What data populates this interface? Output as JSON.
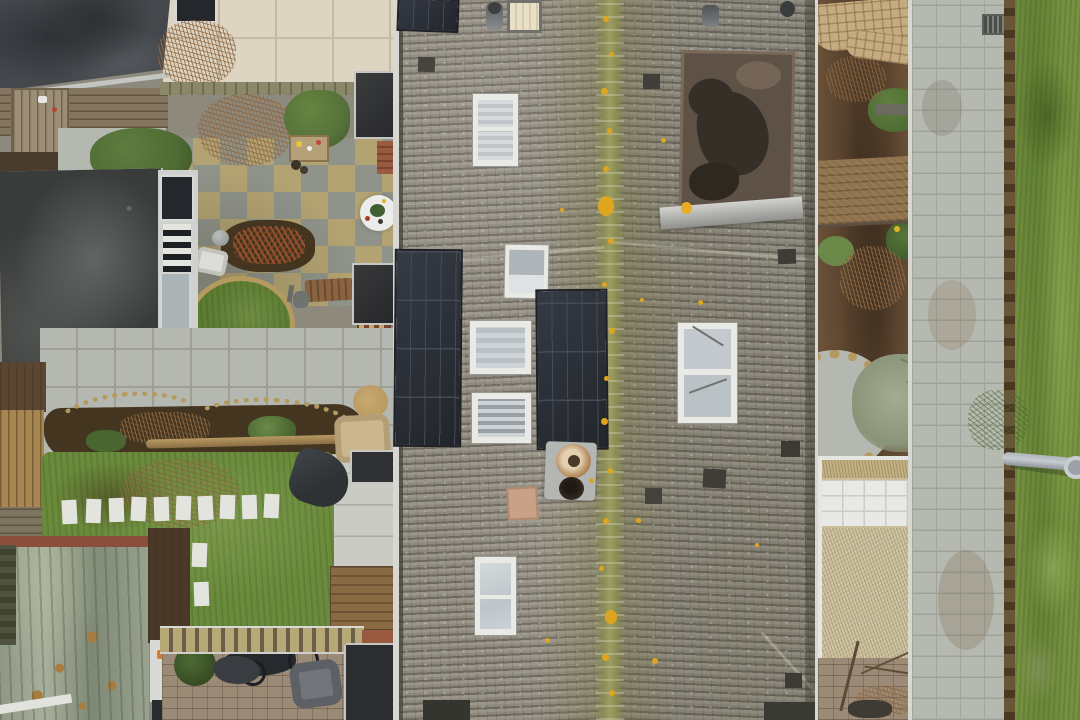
{
  "scene": {
    "description": "Top-down aerial drone photo of a row of terraced houses in winter: a large weathered grey tiled pitched roof runs vertically through the center with a moss-and-lichen covered ridge, white skylight windows, dark solar panels, a chimney and a dark repaired patch of roof tiles. Left side shows back gardens with checkered and grey paving, lawns with stepping stones, fences, sheds, a pergola with bicycles and flat bitumen roofs. Right side shows a front garden with curved cobblestone edging, shrubs and bare winter plants, a gravel-topped porch roof with white skylight tiles, a grey paver sidewalk and a grass verge with a street lamp.",
    "view": "orthographic top-down",
    "season": "winter"
  },
  "objects": [
    "center-pitched-roof",
    "mossy-ridge",
    "lichen-spots",
    "solar-panels",
    "skylight-windows",
    "roof-repair-patch",
    "chimney",
    "vent-caps",
    "left-back-gardens",
    "beige-patio",
    "checkered-paving",
    "circular-lawn",
    "garden-table",
    "flat-bitumen-roof",
    "slate-roof",
    "mossy-garage-roof",
    "stepping-stones",
    "wavy-brick-border",
    "pergola",
    "bicycles",
    "garden-chair",
    "front-garden",
    "cobblestone-path",
    "porch-roof",
    "gravel-flat-roof",
    "white-skylight-strip",
    "sidewalk",
    "grass-verge",
    "street-lamp",
    "fences",
    "sheds"
  ],
  "palette": {
    "roofBase": "#8E897D",
    "roofRowDark": "#6F6A60",
    "roofRowLight": "#9B968A",
    "roofBase2": "#878276",
    "roofRowDark2": "#67645B",
    "roofRowLight2": "#938E83",
    "mossRidge": "#8A8C55",
    "mossRidgeLight": "#9C9E62",
    "lichenYellow": "#DFA51F",
    "gutterWhite": "#D8D7D2",
    "eaveDark": "#3E3D38",
    "solarGrid": "#454B55",
    "solarFrame": "#1F2126",
    "veluxFrame": "#E9E9E5",
    "veluxGlass": "#C3C9CD",
    "veluxGlassDark": "#AEB5BA",
    "louvreDark": "#98A0A5",
    "repairBase": "#5E5146",
    "repairDark": "#362F27",
    "metalStrip": "#C0C1BD",
    "chimneyCap": "#E2D0B0",
    "chimneyCapDark": "#B98F62",
    "pipeDark": "#352C22",
    "patchTan": "#C9A186",
    "bitumen": "#3A3C3B",
    "bitumenWet": "#6A6E6A",
    "slate": "#44484C",
    "slateDark": "#2F3337",
    "mossyRoof": "#97A08C",
    "rustDot": "#A87B3F",
    "fasciaRed": "#8A4F3A",
    "patioBeige": "#DDD5C2",
    "patioLine": "#C4BBA6",
    "checkTan": "#B3A372",
    "checkGrey": "#8F938A",
    "pavingGrey": "#B5B7B1",
    "pavingLine": "#9EA098",
    "pavingWhite": "#CACBC5",
    "lawnGreen": "#6A8B3C",
    "lawnDark": "#4F5C2A",
    "lawnCircle": "#5C7D33",
    "soilDark": "#43351F",
    "soilBrown": "#6B5138",
    "shrubBrown": "#8A6A47",
    "hedgeGreen": "#4E6B33",
    "bushGreen": "#55713A",
    "brickEdge": "#B59A5F",
    "stoneWhite": "#E4E4DE",
    "woodTan": "#A8864F",
    "woodBrown": "#5A4632",
    "woodGrey": "#7D7461",
    "shedBrown": "#4A3828",
    "pergolaSlat": "#B7A878",
    "pergolaGap": "#6B5F48",
    "brickPatio": "#9B8A76",
    "bikeDark": "#26292D",
    "chairGrey": "#71757A",
    "tarpDark": "#2E3234",
    "benchWood": "#7A5636",
    "sofaBeige": "#CBB68E",
    "tableWood": "#B99A62",
    "whiteTable": "#ECECEA",
    "cobbleTan": "#C6AB80",
    "sidewalkGrey": "#B6B9B0",
    "sidewalkLine": "#9FA298",
    "curbWhite": "#D8D8D2",
    "grassGreen": "#74923F",
    "grassDark": "#5D7C34",
    "grassLight": "#8FAE5E",
    "soilEdge": "#6B5537",
    "lampPole": "#C6CBCF",
    "lampPoleDark": "#8E959B",
    "lampHead": "#9AA2A8",
    "porchTile": "#8A7252",
    "gravelTan": "#C9BD9A",
    "whiteTiles": "#E8E8E4",
    "railDark": "#3A4034",
    "treeGrey": "#8A9478",
    "whiteWall": "#D9D9D5",
    "orangeSign": "#D97B2A",
    "glassDark": "#24282C",
    "cladWhite": "#CFD1CE",
    "glassBlue": "#AAB3B6"
  }
}
